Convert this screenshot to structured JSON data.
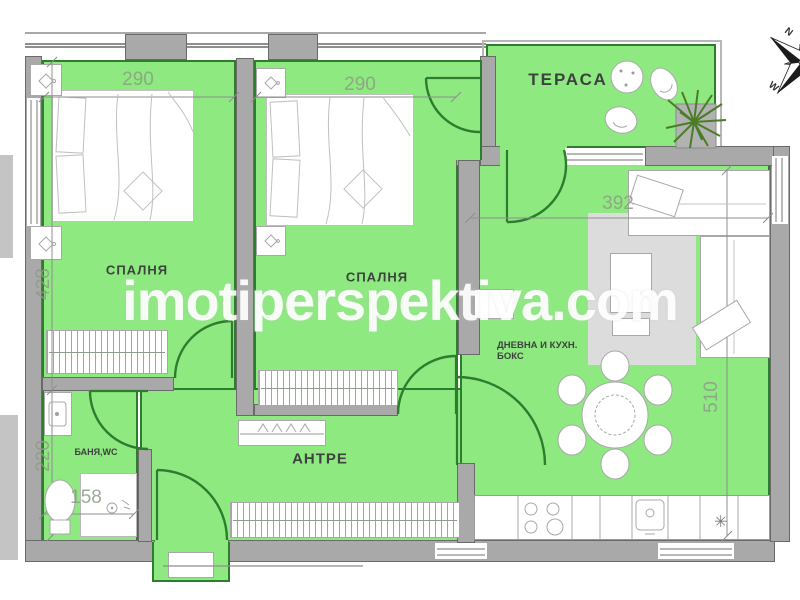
{
  "watermark": "imotiperspektiva.com",
  "compass": {
    "north": "N",
    "west": "W"
  },
  "rooms": {
    "bedroom1": {
      "name": "СПАЛНЯ",
      "width_cm": "290",
      "height_cm": "428"
    },
    "bedroom2": {
      "name": "СПАЛНЯ",
      "width_cm": "290"
    },
    "terrace": {
      "name": "ТЕРАСА"
    },
    "living": {
      "name_line1": "ДНЕВНА И КУХН.",
      "name_line2": "БОКС",
      "width_cm": "392",
      "height_cm": "510"
    },
    "hall": {
      "name": "АНТРЕ"
    },
    "bathroom": {
      "name": "БАНЯ,WC",
      "height_cm": "220",
      "width_cm": "158"
    }
  },
  "glyphs": {
    "boiler": "✳"
  },
  "colors": {
    "room_fill": "#8ee981",
    "room_line": "#2e7d2e",
    "wall_fill": "#a9a9a9",
    "wall_line": "#6a6a6a",
    "furn_line": "#a8a8a8",
    "sketch_line": "#c0c0c0",
    "closet_line": "#8f9b8f",
    "dim_text": "#8e9c86",
    "label_text": "#3c423d",
    "rug_fill": "#dcdcdc",
    "plant": "#4b7c26",
    "railing": "#b7b7b7",
    "watermark": "#ffffff"
  }
}
